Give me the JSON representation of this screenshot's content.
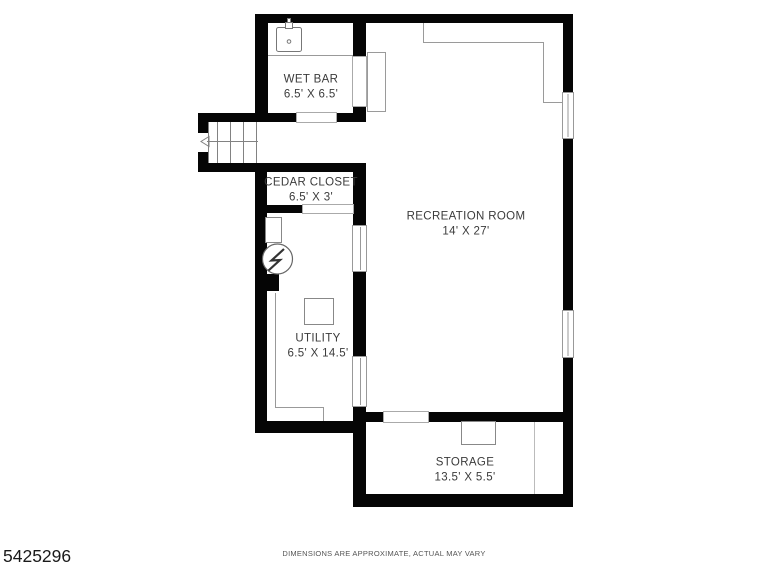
{
  "rooms": [
    {
      "name": "WET BAR",
      "dims": "6.5' X 6.5'"
    },
    {
      "name": "CEDAR CLOSET",
      "dims": "6.5' X 3'"
    },
    {
      "name": "RECREATION ROOM",
      "dims": "14' X 27'"
    },
    {
      "name": "UTILITY",
      "dims": "6.5' X 14.5'"
    },
    {
      "name": "STORAGE",
      "dims": "13.5' X 5.5'"
    }
  ],
  "fixtures": {
    "wet_bar": [
      "sink-icon"
    ],
    "utility": [
      "water-heater-icon",
      "furnace-icon",
      "equipment-icon"
    ],
    "stairs": [
      "stair-direction-arrow"
    ],
    "storage": [
      "equipment-icon"
    ]
  },
  "footer": {
    "disclaimer": "DIMENSIONS ARE APPROXIMATE, ACTUAL MAY VARY"
  },
  "listing_id": "5425296",
  "colors": {
    "wall": "#050505",
    "background": "#ffffff",
    "fixture_line": "#8a8a8a",
    "label_text": "#3b3b3b"
  }
}
